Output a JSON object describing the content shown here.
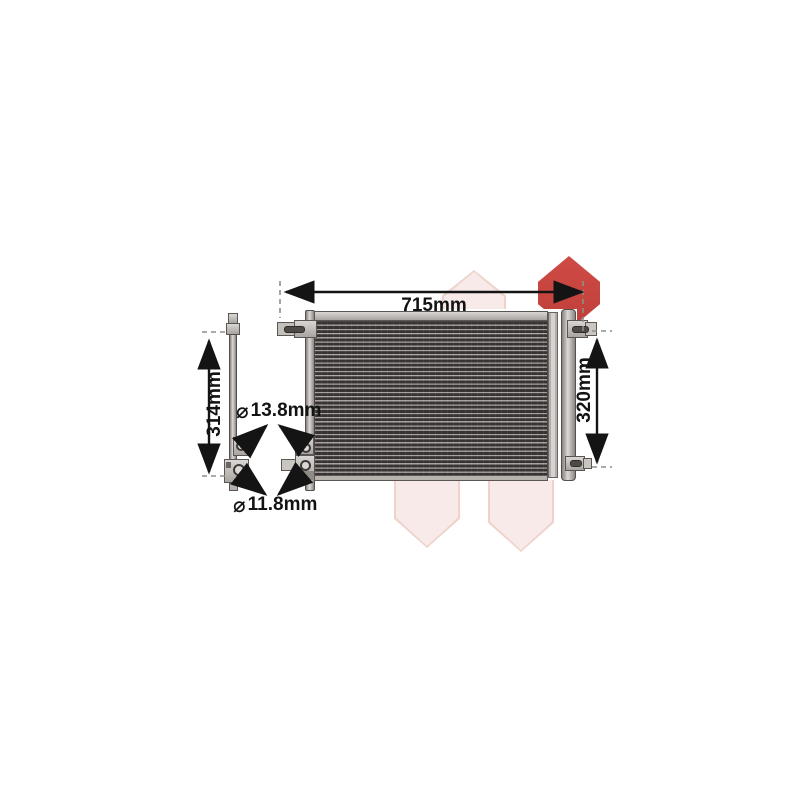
{
  "labels": {
    "width": "715mm",
    "height": "320mm",
    "side_height": "314mm",
    "top_fitting": "13.8mm",
    "bottom_fitting": "11.8mm"
  },
  "icons": {
    "diameter": "⌀"
  },
  "colors": {
    "dimension_line": "#141414",
    "watermark_pink": "#f8eae8",
    "watermark_pink_edge": "#efd2cc",
    "watermark_red": "#c7443e",
    "metal_light": "#d9d6d3",
    "fin_dark": "#393536"
  }
}
